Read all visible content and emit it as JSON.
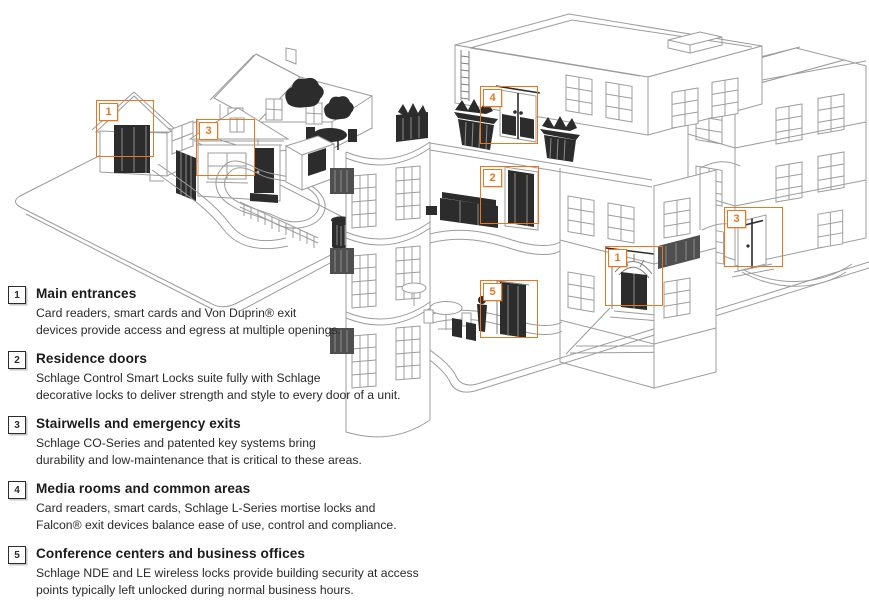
{
  "colors": {
    "accent": "#E87722",
    "line": "#9c9c9c",
    "dark": "#2c2c2c",
    "text": "#231f20"
  },
  "legend": {
    "items": [
      {
        "number": "1",
        "title": "Main entrances",
        "lines": [
          "Card readers, smart cards and Von Duprin® exit",
          "devices provide access and egress at multiple openings."
        ]
      },
      {
        "number": "2",
        "title": "Residence doors",
        "lines": [
          "Schlage Control Smart Locks suite fully with Schlage",
          "decorative locks to deliver strength and style to every door of a unit."
        ]
      },
      {
        "number": "3",
        "title": "Stairwells and emergency exits",
        "lines": [
          "Schlage CO-Series and patented key systems bring",
          "durability and low-maintenance that is critical to these areas."
        ]
      },
      {
        "number": "4",
        "title": "Media rooms and common areas",
        "lines": [
          "Card readers, smart cards, Schlage L-Series mortise locks and",
          "Falcon® exit devices balance ease of use, control and compliance."
        ]
      },
      {
        "number": "5",
        "title": "Conference centers and business offices",
        "lines": [
          "Schlage NDE and LE wireless locks provide building security at access",
          "points typically left unlocked during normal business hours."
        ]
      }
    ]
  },
  "diagram": {
    "markers": [
      {
        "number": "1",
        "area": "house-front-entrance",
        "x": 96,
        "y": 100,
        "w": 58,
        "h": 57
      },
      {
        "number": "3",
        "area": "house-side-exit",
        "x": 196,
        "y": 119,
        "w": 59,
        "h": 57
      },
      {
        "number": "4",
        "area": "media-room-roof-terrace",
        "x": 480,
        "y": 86,
        "w": 58,
        "h": 58
      },
      {
        "number": "2",
        "area": "residence-unit-door",
        "x": 480,
        "y": 166,
        "w": 59,
        "h": 58
      },
      {
        "number": "5",
        "area": "office-ground-floor",
        "x": 480,
        "y": 280,
        "w": 58,
        "h": 58
      },
      {
        "number": "1",
        "area": "main-building-entrance",
        "x": 605,
        "y": 246,
        "w": 58,
        "h": 60
      },
      {
        "number": "3",
        "area": "stairwell-side-door",
        "x": 724,
        "y": 207,
        "w": 59,
        "h": 60
      }
    ]
  }
}
